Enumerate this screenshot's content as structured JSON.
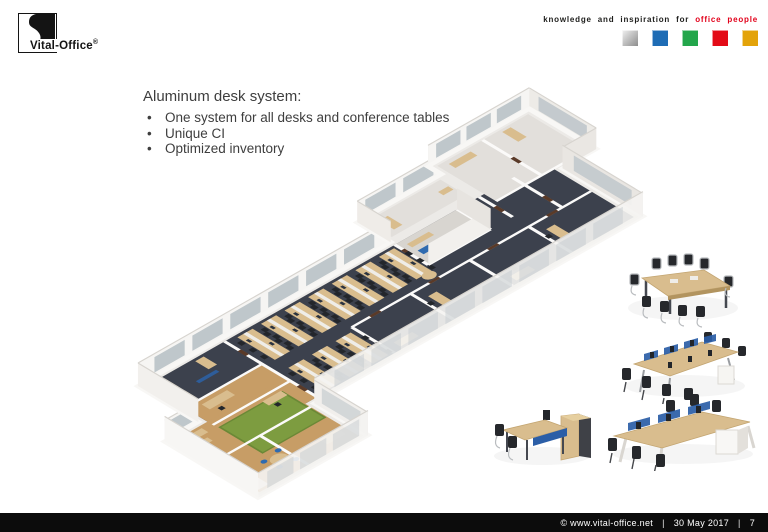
{
  "slide": {
    "header": {
      "logo": {
        "text": "Vital-Office",
        "registered": "®",
        "mark_icon": "yin-yang-swoosh"
      },
      "tagline": {
        "prefix": "knowledge and inspiration for",
        "highlight": "office people"
      },
      "brand_squares": [
        {
          "name": "silver",
          "color": "#b9b9b9"
        },
        {
          "name": "blue",
          "color": "#1e6cb5"
        },
        {
          "name": "green",
          "color": "#23a64b"
        },
        {
          "name": "red",
          "color": "#e30b17"
        },
        {
          "name": "amber",
          "color": "#e3a30a"
        }
      ]
    },
    "content": {
      "heading": "Aluminum desk system:",
      "bullets": [
        "One system for all desks and conference tables",
        "Unique CI",
        "Optimized inventory"
      ]
    },
    "illustrations": {
      "main": "isometric-3d-office-floorplan-render",
      "products": [
        "conference-table-with-chairs",
        "bench-desks-with-blue-screens",
        "desk-with-storage-cabinet",
        "six-person-bench-desk"
      ]
    },
    "palette": {
      "accent_red": "#e2001a",
      "desk_wood": "#d9bd8e",
      "carpet_dark": "#3c414d",
      "moss_green": "#7d9c40",
      "screen_blue": "#2b5ea7",
      "footer_bg": "#0c0c0c"
    },
    "footer": {
      "copyright": "©  www.vital-office.net",
      "date": "30 May 2017",
      "page": "7",
      "separator": "|"
    }
  }
}
